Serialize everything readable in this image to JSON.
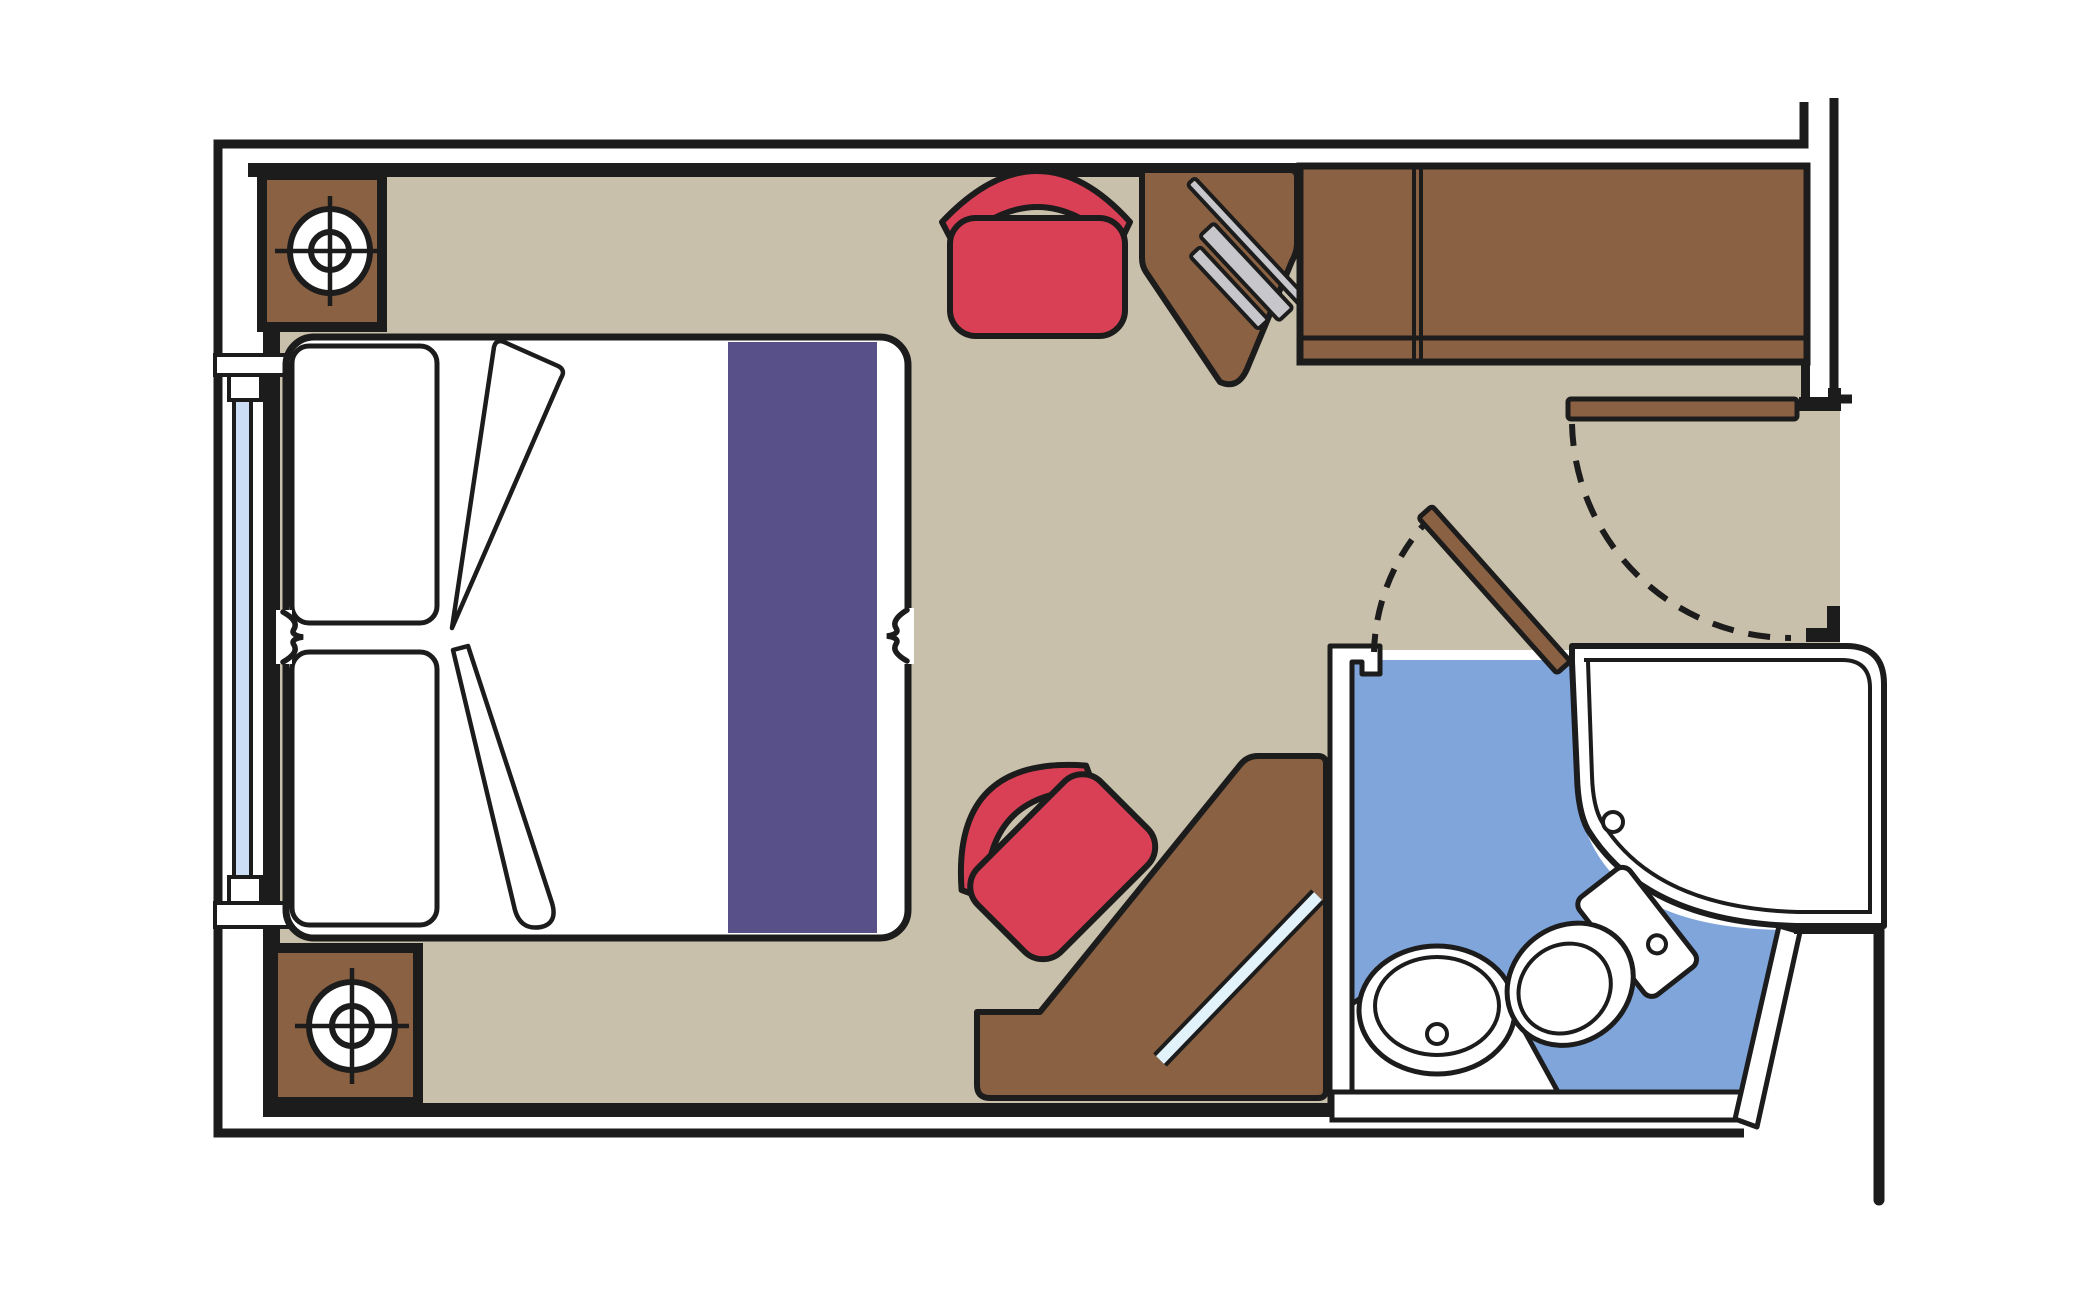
{
  "document": {
    "kind": "floor-plan",
    "subject": "cabin-with-bathroom-top-view"
  },
  "palette": {
    "line": "#1c1c1c",
    "floor": "#c9c0ab",
    "wood": "#8a6143",
    "wood_dark": "#7d5738",
    "red": "#d94055",
    "purple": "#585189",
    "bath_blue": "#7fa5db",
    "glass_blue": "#cbdef5",
    "mirror_blue": "#e2f2fb",
    "tv_gray": "#c7c7cb",
    "white": "#ffffff"
  },
  "elements": {
    "bed": "double-bed",
    "pillows": [
      "pillow-left-upper",
      "pillow-left-lower"
    ],
    "runner": "bed-runner-stripe",
    "nightstands": [
      "nightstand-top-left",
      "nightstand-bottom-left"
    ],
    "lamps": [
      "lamp-top",
      "lamp-bottom"
    ],
    "chairs": [
      "stool-top",
      "stool-at-vanity"
    ],
    "desks": [
      "corner-desk-with-tv",
      "vanity-desk-with-mirror"
    ],
    "wardrobe": "two-door-wardrobe",
    "window": "cabin-window",
    "doors": [
      "entry-door-with-swing",
      "bathroom-door-with-swing"
    ],
    "bathroom": [
      "shower",
      "toilet",
      "sink-counter"
    ]
  }
}
